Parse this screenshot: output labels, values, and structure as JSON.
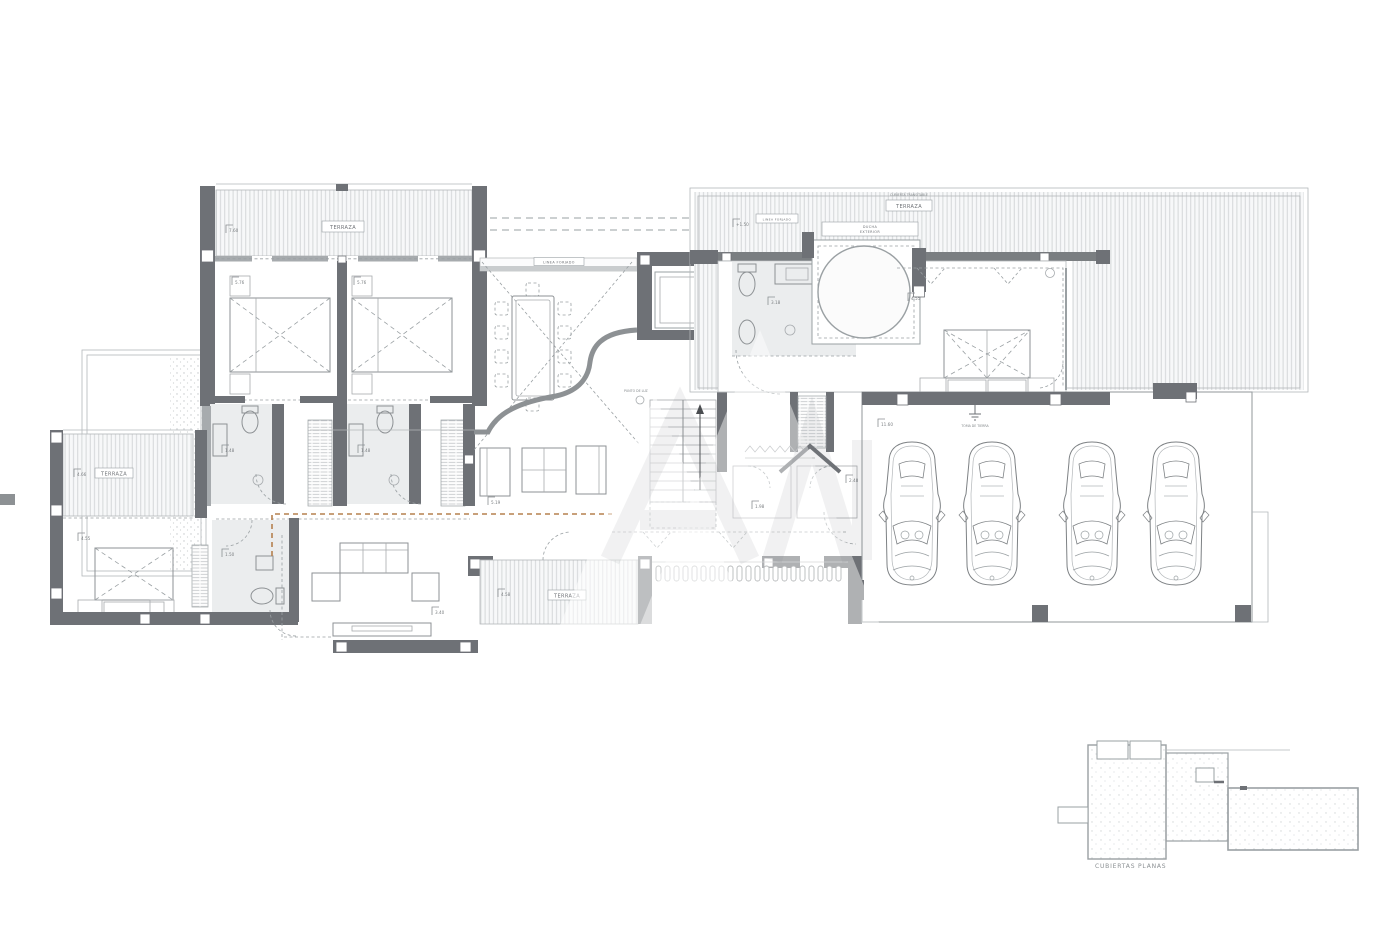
{
  "labels": {
    "terraza": "TERRAZA",
    "cubiertas_planas": "CUBIERTAS PLANAS",
    "cubierta_transitable": "CUBIERTA TRANSITABLE",
    "linea_forjado": "LINEA FORJADO",
    "patio": "PATIO",
    "punto_luz": "PUNTO DE LUZ",
    "toma_tierra": "TOMA DE TIERRA",
    "ducha1": "DUCHA",
    "ducha2": "EXTERIOR"
  },
  "levels": {
    "l1": "7.60",
    "l2": "5.76",
    "l3": "5.76",
    "l4": "4.66",
    "l5": "4.55",
    "l6": "4.58",
    "l7": "3.40",
    "l8": "5.19",
    "l9": "+1.50",
    "l10": "11.60",
    "l11": "4.55",
    "l12": "3.18",
    "l13": "2.48",
    "l14": "1.98",
    "l15": "1.48",
    "l16": "1.48",
    "l17": "1.50"
  },
  "colors": {
    "wall": "#6e7176",
    "section_line": "#b5804f",
    "hatch": "#d4d7d9"
  }
}
